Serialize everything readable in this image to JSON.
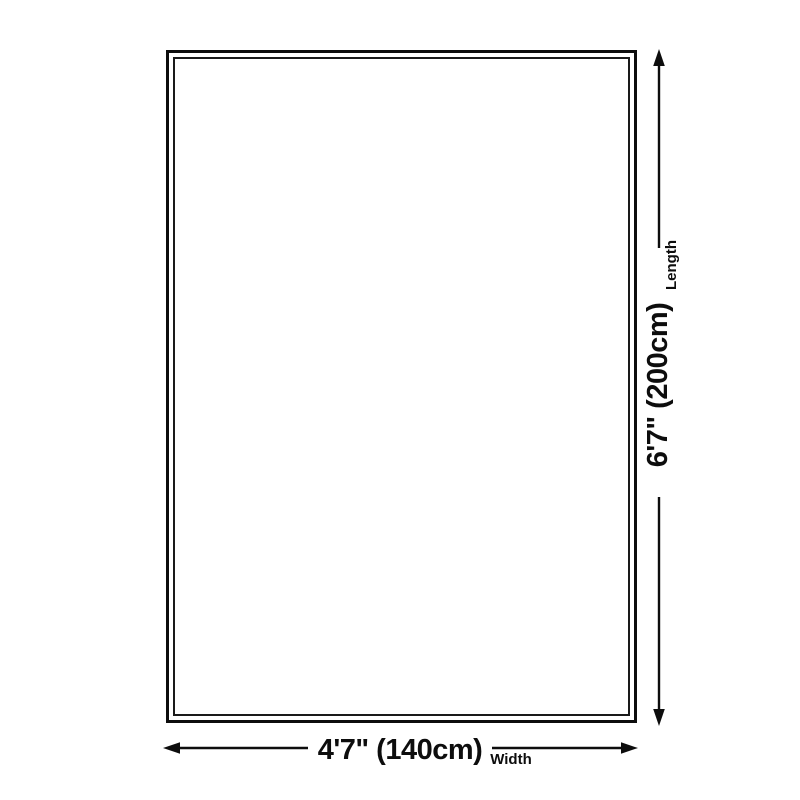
{
  "diagram": {
    "length": {
      "value": "6'7\" (200cm)",
      "label": "Length"
    },
    "width": {
      "value": "4'7\" (140cm)",
      "label": "Width"
    }
  },
  "icons": {
    "up": "arrow-up-icon",
    "down": "arrow-down-icon",
    "left": "arrow-left-icon",
    "right": "arrow-right-icon"
  },
  "colors": {
    "ink": "#0d0d0d",
    "background": "#ffffff"
  }
}
